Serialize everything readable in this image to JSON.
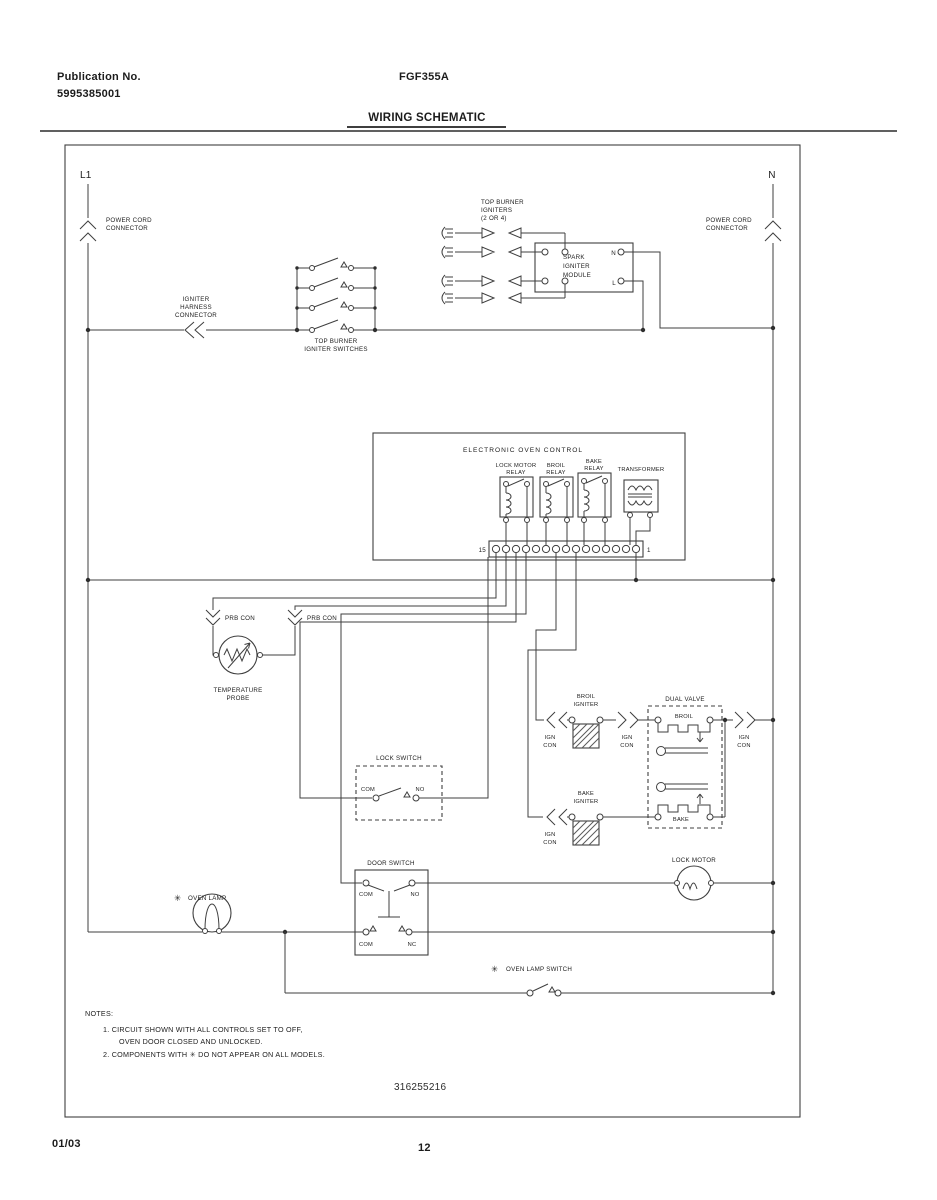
{
  "header": {
    "publication_label": "Publication No.",
    "publication_number": "5995385001",
    "model": "FGF355A",
    "title": "WIRING SCHEMATIC"
  },
  "footer": {
    "date": "01/03",
    "page": "12"
  },
  "diagram": {
    "part_number": "316255216",
    "l1": "L1",
    "n": "N",
    "power_cord": [
      "POWER CORD",
      "CONNECTOR"
    ],
    "igniter_harness": [
      "IGNITER",
      "HARNESS",
      "CONNECTOR"
    ],
    "top_burner_switches": [
      "TOP BURNER",
      "IGNITER SWITCHES"
    ],
    "top_burner_igniters": [
      "TOP BURNER",
      "IGNITERS",
      "(2 OR 4)"
    ],
    "spark_module": [
      "SPARK",
      "IGNITER",
      "MODULE"
    ],
    "term_n": "N",
    "term_l": "L",
    "eoc": "ELECTRONIC OVEN CONTROL",
    "lock_motor_relay": [
      "LOCK MOTOR",
      "RELAY"
    ],
    "broil_relay": [
      "BROIL",
      "RELAY"
    ],
    "bake_relay": [
      "BAKE",
      "RELAY"
    ],
    "transformer": "TRANSFORMER",
    "strip_left": "15",
    "strip_right": "1",
    "prb_con": "PRB CON",
    "temp_probe": [
      "TEMPERATURE",
      "PROBE"
    ],
    "broil_igniter": [
      "BROIL",
      "IGNITER"
    ],
    "bake_igniter": [
      "BAKE",
      "IGNITER"
    ],
    "ign": "IGN",
    "con": "CON",
    "dual_valve": "DUAL VALVE",
    "broil": "BROIL",
    "bake": "BAKE",
    "lock_switch": "LOCK SWITCH",
    "door_switch": "DOOR SWITCH",
    "lock_motor": "LOCK MOTOR",
    "oven_lamp": "OVEN LAMP",
    "oven_lamp_switch": "OVEN LAMP SWITCH",
    "com": "COM",
    "no": "NO",
    "nc": "NC",
    "star": "✳",
    "notes": {
      "heading": "NOTES:",
      "lines": [
        "1.   CIRCUIT SHOWN WITH ALL CONTROLS SET TO OFF,",
        "OVEN DOOR CLOSED AND UNLOCKED.",
        "2.   COMPONENTS WITH  ✳  DO NOT APPEAR ON ALL MODELS."
      ]
    }
  }
}
